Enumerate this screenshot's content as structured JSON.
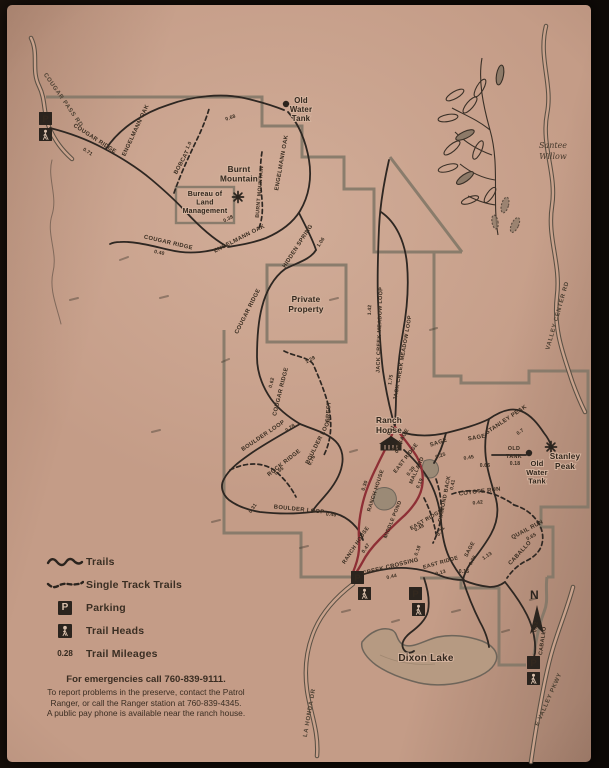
{
  "photo": {
    "paper_color": "#c49c87",
    "ink_color": "#33281e",
    "boundary_color": "#837868",
    "highlight_color": "#8e2f35"
  },
  "compass": {
    "label": "N"
  },
  "illustration_caption": [
    "Santee",
    "Willow"
  ],
  "legend": {
    "items": [
      {
        "symbol": "trails-line",
        "label": "Trails"
      },
      {
        "symbol": "single-track-line",
        "label": "Single Track Trails"
      },
      {
        "symbol": "parking-icon",
        "label": "Parking"
      },
      {
        "symbol": "trailhead-icon",
        "label": "Trail Heads"
      },
      {
        "symbol": "mileage-number",
        "symbol_text": "0.28",
        "label": "Trail Mileages"
      }
    ]
  },
  "notes": {
    "emergency": "For emergencies call 760-839-9111.",
    "line1": "To report problems in the preserve, contact the Patrol",
    "line2": "Ranger, or call the Ranger station at 760-839-4345.",
    "line3": "A public pay phone is available near the ranch house."
  },
  "markers": {
    "parking_glyph": "P",
    "parking": [
      [
        39,
        112
      ],
      [
        351,
        571
      ],
      [
        409,
        587
      ],
      [
        527,
        656
      ]
    ],
    "trailheads": [
      [
        39,
        128
      ],
      [
        358,
        587
      ],
      [
        412,
        603
      ],
      [
        527,
        672
      ]
    ],
    "peaks": [
      [
        238,
        197
      ],
      [
        551,
        447
      ]
    ],
    "tanks": [
      [
        286,
        104
      ],
      [
        529,
        453
      ]
    ]
  },
  "landmarks": [
    {
      "id": "old-water-tank-north",
      "x": 301,
      "y": 103,
      "s": 7.8,
      "lh": 9,
      "lines": [
        "Old",
        "Water",
        "Tank"
      ]
    },
    {
      "id": "burnt-mountain",
      "x": 239,
      "y": 172,
      "s": 8.2,
      "lh": 9.5,
      "lines": [
        "Burnt",
        "Mountain"
      ]
    },
    {
      "id": "bureau-of-land-management",
      "x": 205,
      "y": 196,
      "s": 7,
      "lh": 8.6,
      "lines": [
        "Bureau of",
        "Land",
        "Management"
      ]
    },
    {
      "id": "private-property",
      "x": 306,
      "y": 302,
      "s": 8.2,
      "lh": 10,
      "lines": [
        "Private",
        "Property"
      ]
    },
    {
      "id": "ranch-house",
      "x": 389,
      "y": 423,
      "s": 8.2,
      "lh": 10,
      "lines": [
        "Ranch",
        "House"
      ]
    },
    {
      "id": "stanley-peak",
      "x": 565,
      "y": 459,
      "s": 8.2,
      "lh": 10,
      "lines": [
        "Stanley",
        "Peak"
      ]
    },
    {
      "id": "old-water-tank-east",
      "x": 537,
      "y": 466,
      "s": 7.5,
      "lh": 8.8,
      "lines": [
        "Old",
        "Water",
        "Tank"
      ]
    },
    {
      "id": "dixon-lake",
      "x": 426,
      "y": 661,
      "s": 10,
      "lh": 11,
      "lines": [
        "Dixon Lake"
      ]
    }
  ],
  "trail_labels": [
    {
      "text": "COUGAR PASS RD",
      "x": 62,
      "y": 101,
      "r": 55,
      "s": 6,
      "k": "road"
    },
    {
      "text": "COUGAR RIDGE",
      "x": 94,
      "y": 140,
      "r": 33,
      "s": 5.8,
      "k": "trail"
    },
    {
      "text": "0.71",
      "x": 87,
      "y": 153,
      "r": 33,
      "s": 5,
      "k": "mile"
    },
    {
      "text": "ENGELMANN OAK",
      "x": 137,
      "y": 131,
      "r": -65,
      "s": 5.8,
      "k": "trail"
    },
    {
      "text": "BOBCAT",
      "x": 183,
      "y": 163,
      "r": -62,
      "s": 5.8,
      "k": "trail"
    },
    {
      "text": "1.0",
      "x": 190,
      "y": 146,
      "r": -62,
      "s": 5,
      "k": "mile"
    },
    {
      "text": "0.68",
      "x": 231,
      "y": 119,
      "r": -20,
      "s": 5,
      "k": "mile"
    },
    {
      "text": "ENGELMANN OAK",
      "x": 283,
      "y": 163,
      "r": -80,
      "s": 5.8,
      "k": "trail"
    },
    {
      "text": "BURNT MOUNTAIN",
      "x": 261,
      "y": 192,
      "r": -85,
      "s": 5.2,
      "k": "trail"
    },
    {
      "text": "ENGELMANN OAK",
      "x": 240,
      "y": 240,
      "r": -27,
      "s": 5.8,
      "k": "trail"
    },
    {
      "text": "0.38",
      "x": 229,
      "y": 220,
      "r": -27,
      "s": 5,
      "k": "mile"
    },
    {
      "text": "HIDDEN SPRING",
      "x": 299,
      "y": 247,
      "r": -57,
      "s": 5.8,
      "k": "trail"
    },
    {
      "text": "1.06",
      "x": 322,
      "y": 243,
      "r": -57,
      "s": 5,
      "k": "mile"
    },
    {
      "text": "COUGAR RIDGE",
      "x": 168,
      "y": 244,
      "r": 13,
      "s": 5.8,
      "k": "trail"
    },
    {
      "text": "0.40",
      "x": 159,
      "y": 254,
      "r": 13,
      "s": 5,
      "k": "mile"
    },
    {
      "text": "COUGAR RIDGE",
      "x": 249,
      "y": 312,
      "r": -63,
      "s": 5.8,
      "k": "trail"
    },
    {
      "text": "COUGAR RIDGE",
      "x": 282,
      "y": 392,
      "r": -76,
      "s": 5.8,
      "k": "trail"
    },
    {
      "text": "0.62",
      "x": 273,
      "y": 383,
      "r": -76,
      "s": 5,
      "k": "mile"
    },
    {
      "text": "1.28",
      "x": 311,
      "y": 361,
      "r": -28,
      "s": 5,
      "k": "mile"
    },
    {
      "text": "CREST",
      "x": 330,
      "y": 412,
      "r": -86,
      "s": 5.8,
      "k": "trail"
    },
    {
      "text": "JACK CREEK MEADOW LOOP",
      "x": 381,
      "y": 330,
      "r": -88,
      "s": 5.4,
      "k": "trail"
    },
    {
      "text": "1.42",
      "x": 371,
      "y": 310,
      "r": -88,
      "s": 5,
      "k": "mile"
    },
    {
      "text": "JACK CREEK MEADOW LOOP",
      "x": 404,
      "y": 358,
      "r": -80,
      "s": 5.4,
      "k": "trail"
    },
    {
      "text": "1.75",
      "x": 392,
      "y": 380,
      "r": -80,
      "s": 5,
      "k": "mile"
    },
    {
      "text": "BOULDER LOOP",
      "x": 264,
      "y": 437,
      "r": -34,
      "s": 5.8,
      "k": "trail"
    },
    {
      "text": "0.28",
      "x": 291,
      "y": 429,
      "r": -34,
      "s": 5,
      "k": "mile"
    },
    {
      "text": "BOULDER LOOP",
      "x": 320,
      "y": 442,
      "r": -63,
      "s": 5.8,
      "k": "trail"
    },
    {
      "text": "0.76",
      "x": 313,
      "y": 461,
      "r": -63,
      "s": 5,
      "k": "mile"
    },
    {
      "text": "ROCK RIDGE",
      "x": 285,
      "y": 464,
      "r": -38,
      "s": 5.8,
      "k": "trail"
    },
    {
      "text": "0.65",
      "x": 280,
      "y": 472,
      "r": -38,
      "s": 5,
      "k": "mile"
    },
    {
      "text": "BOULDER LOOP",
      "x": 299,
      "y": 511,
      "r": 6,
      "s": 5.8,
      "k": "trail"
    },
    {
      "text": "0.46",
      "x": 331,
      "y": 516,
      "r": 6,
      "s": 5,
      "k": "mile"
    },
    {
      "text": "0.31",
      "x": 254,
      "y": 509,
      "r": -55,
      "s": 5,
      "k": "mile"
    },
    {
      "text": "0.11",
      "x": 392,
      "y": 431,
      "r": -60,
      "s": 5,
      "k": "mile"
    },
    {
      "text": "SAGE",
      "x": 405,
      "y": 437,
      "r": -62,
      "s": 5.4,
      "k": "trail"
    },
    {
      "text": "0.37",
      "x": 400,
      "y": 449,
      "r": -62,
      "s": 5,
      "k": "mile"
    },
    {
      "text": "EAST RIDGE",
      "x": 407,
      "y": 459,
      "r": -52,
      "s": 5.4,
      "k": "trail"
    },
    {
      "text": "0.36",
      "x": 398,
      "y": 447,
      "r": -52,
      "s": 5,
      "k": "mile"
    },
    {
      "text": "0.39",
      "x": 412,
      "y": 472,
      "r": -52,
      "s": 5,
      "k": "mile"
    },
    {
      "text": "SAGE",
      "x": 439,
      "y": 444,
      "r": -18,
      "s": 5.8,
      "k": "trail"
    },
    {
      "text": "0.25",
      "x": 441,
      "y": 457,
      "r": -18,
      "s": 5,
      "k": "mile"
    },
    {
      "text": "SAGE",
      "x": 477,
      "y": 439,
      "r": -10,
      "s": 5.8,
      "k": "trail"
    },
    {
      "text": "0.45",
      "x": 469,
      "y": 459,
      "r": -10,
      "s": 5,
      "k": "mile"
    },
    {
      "text": "STANLEY PEAK",
      "x": 507,
      "y": 421,
      "r": -34,
      "s": 5.8,
      "k": "trail"
    },
    {
      "text": "0.7",
      "x": 521,
      "y": 433,
      "r": -34,
      "s": 5,
      "k": "mile"
    },
    {
      "text": "OLD",
      "x": 514,
      "y": 450,
      "r": 0,
      "s": 5.4,
      "k": "trail"
    },
    {
      "text": "TANK",
      "x": 514,
      "y": 458,
      "r": 0,
      "s": 5.4,
      "k": "trail"
    },
    {
      "text": "0.18",
      "x": 515,
      "y": 465,
      "r": 0,
      "s": 5,
      "k": "mile"
    },
    {
      "text": "0.66",
      "x": 485,
      "y": 467,
      "r": 0,
      "s": 5,
      "k": "mile"
    },
    {
      "text": "MALLARD",
      "x": 418,
      "y": 471,
      "r": -66,
      "s": 5.4,
      "k": "trail"
    },
    {
      "text": "0.19",
      "x": 421,
      "y": 484,
      "r": -66,
      "s": 5,
      "k": "mile"
    },
    {
      "text": "DIAMOND BACK",
      "x": 446,
      "y": 499,
      "r": -79,
      "s": 5.4,
      "k": "trail"
    },
    {
      "text": "0.41",
      "x": 454,
      "y": 485,
      "r": -79,
      "s": 5,
      "k": "mile"
    },
    {
      "text": "COYOTE RUN",
      "x": 480,
      "y": 493,
      "r": -7,
      "s": 5.8,
      "k": "trail"
    },
    {
      "text": "0.42",
      "x": 478,
      "y": 504,
      "r": -7,
      "s": 5,
      "k": "mile"
    },
    {
      "text": "QUAIL RUN",
      "x": 528,
      "y": 531,
      "r": -28,
      "s": 5.8,
      "k": "trail"
    },
    {
      "text": "0.65",
      "x": 532,
      "y": 538,
      "r": -28,
      "s": 5,
      "k": "mile"
    },
    {
      "text": "CABALLO",
      "x": 521,
      "y": 554,
      "r": -47,
      "s": 5.8,
      "k": "trail"
    },
    {
      "text": "EAST RIDGE",
      "x": 427,
      "y": 521,
      "r": -30,
      "s": 5.4,
      "k": "trail"
    },
    {
      "text": "0.48",
      "x": 420,
      "y": 529,
      "r": -30,
      "s": 5,
      "k": "mile"
    },
    {
      "text": "0.31",
      "x": 442,
      "y": 532,
      "r": -55,
      "s": 5,
      "k": "mile"
    },
    {
      "text": "SAGE",
      "x": 471,
      "y": 550,
      "r": -62,
      "s": 5.4,
      "k": "trail"
    },
    {
      "text": "0.75",
      "x": 474,
      "y": 561,
      "r": -62,
      "s": 5,
      "k": "mile"
    },
    {
      "text": "1.13",
      "x": 488,
      "y": 557,
      "r": -35,
      "s": 5,
      "k": "mile"
    },
    {
      "text": "0.15",
      "x": 464,
      "y": 573,
      "r": 0,
      "s": 5,
      "k": "mile"
    },
    {
      "text": "EAST RIDGE",
      "x": 441,
      "y": 564,
      "r": -16,
      "s": 5.4,
      "k": "trail"
    },
    {
      "text": "0.13",
      "x": 441,
      "y": 574,
      "r": -16,
      "s": 5,
      "k": "mile"
    },
    {
      "text": "0.18",
      "x": 419,
      "y": 551,
      "r": -70,
      "s": 5,
      "k": "mile"
    },
    {
      "text": "MIDDLE POND",
      "x": 394,
      "y": 520,
      "r": -68,
      "s": 5.2,
      "k": "trail"
    },
    {
      "text": "RANCH HOUSE",
      "x": 377,
      "y": 491,
      "r": -72,
      "s": 5.4,
      "k": "trail"
    },
    {
      "text": "0.30",
      "x": 366,
      "y": 486,
      "r": -72,
      "s": 5,
      "k": "mile"
    },
    {
      "text": "RANCH HOUSE",
      "x": 357,
      "y": 546,
      "r": -56,
      "s": 5.4,
      "k": "trail"
    },
    {
      "text": "0.47",
      "x": 367,
      "y": 549,
      "r": -56,
      "s": 5,
      "k": "mile"
    },
    {
      "text": "CREEK CROSSING",
      "x": 391,
      "y": 568,
      "r": -14,
      "s": 5.8,
      "k": "trail"
    },
    {
      "text": "0.44",
      "x": 392,
      "y": 578,
      "r": -14,
      "s": 5,
      "k": "mile"
    },
    {
      "text": "CABALLO",
      "x": 544,
      "y": 641,
      "r": -82,
      "s": 5.4,
      "k": "trail"
    },
    {
      "text": "0.52",
      "x": 537,
      "y": 627,
      "r": -82,
      "s": 5,
      "k": "mile"
    },
    {
      "text": "VALLEY CENTER RD",
      "x": 559,
      "y": 316,
      "r": -74,
      "s": 6,
      "k": "road"
    },
    {
      "text": "LA HONDA DR",
      "x": 311,
      "y": 713,
      "r": -80,
      "s": 6,
      "k": "road"
    },
    {
      "text": "E VALLEY PKWY",
      "x": 550,
      "y": 700,
      "r": -66,
      "s": 6,
      "k": "road"
    }
  ]
}
